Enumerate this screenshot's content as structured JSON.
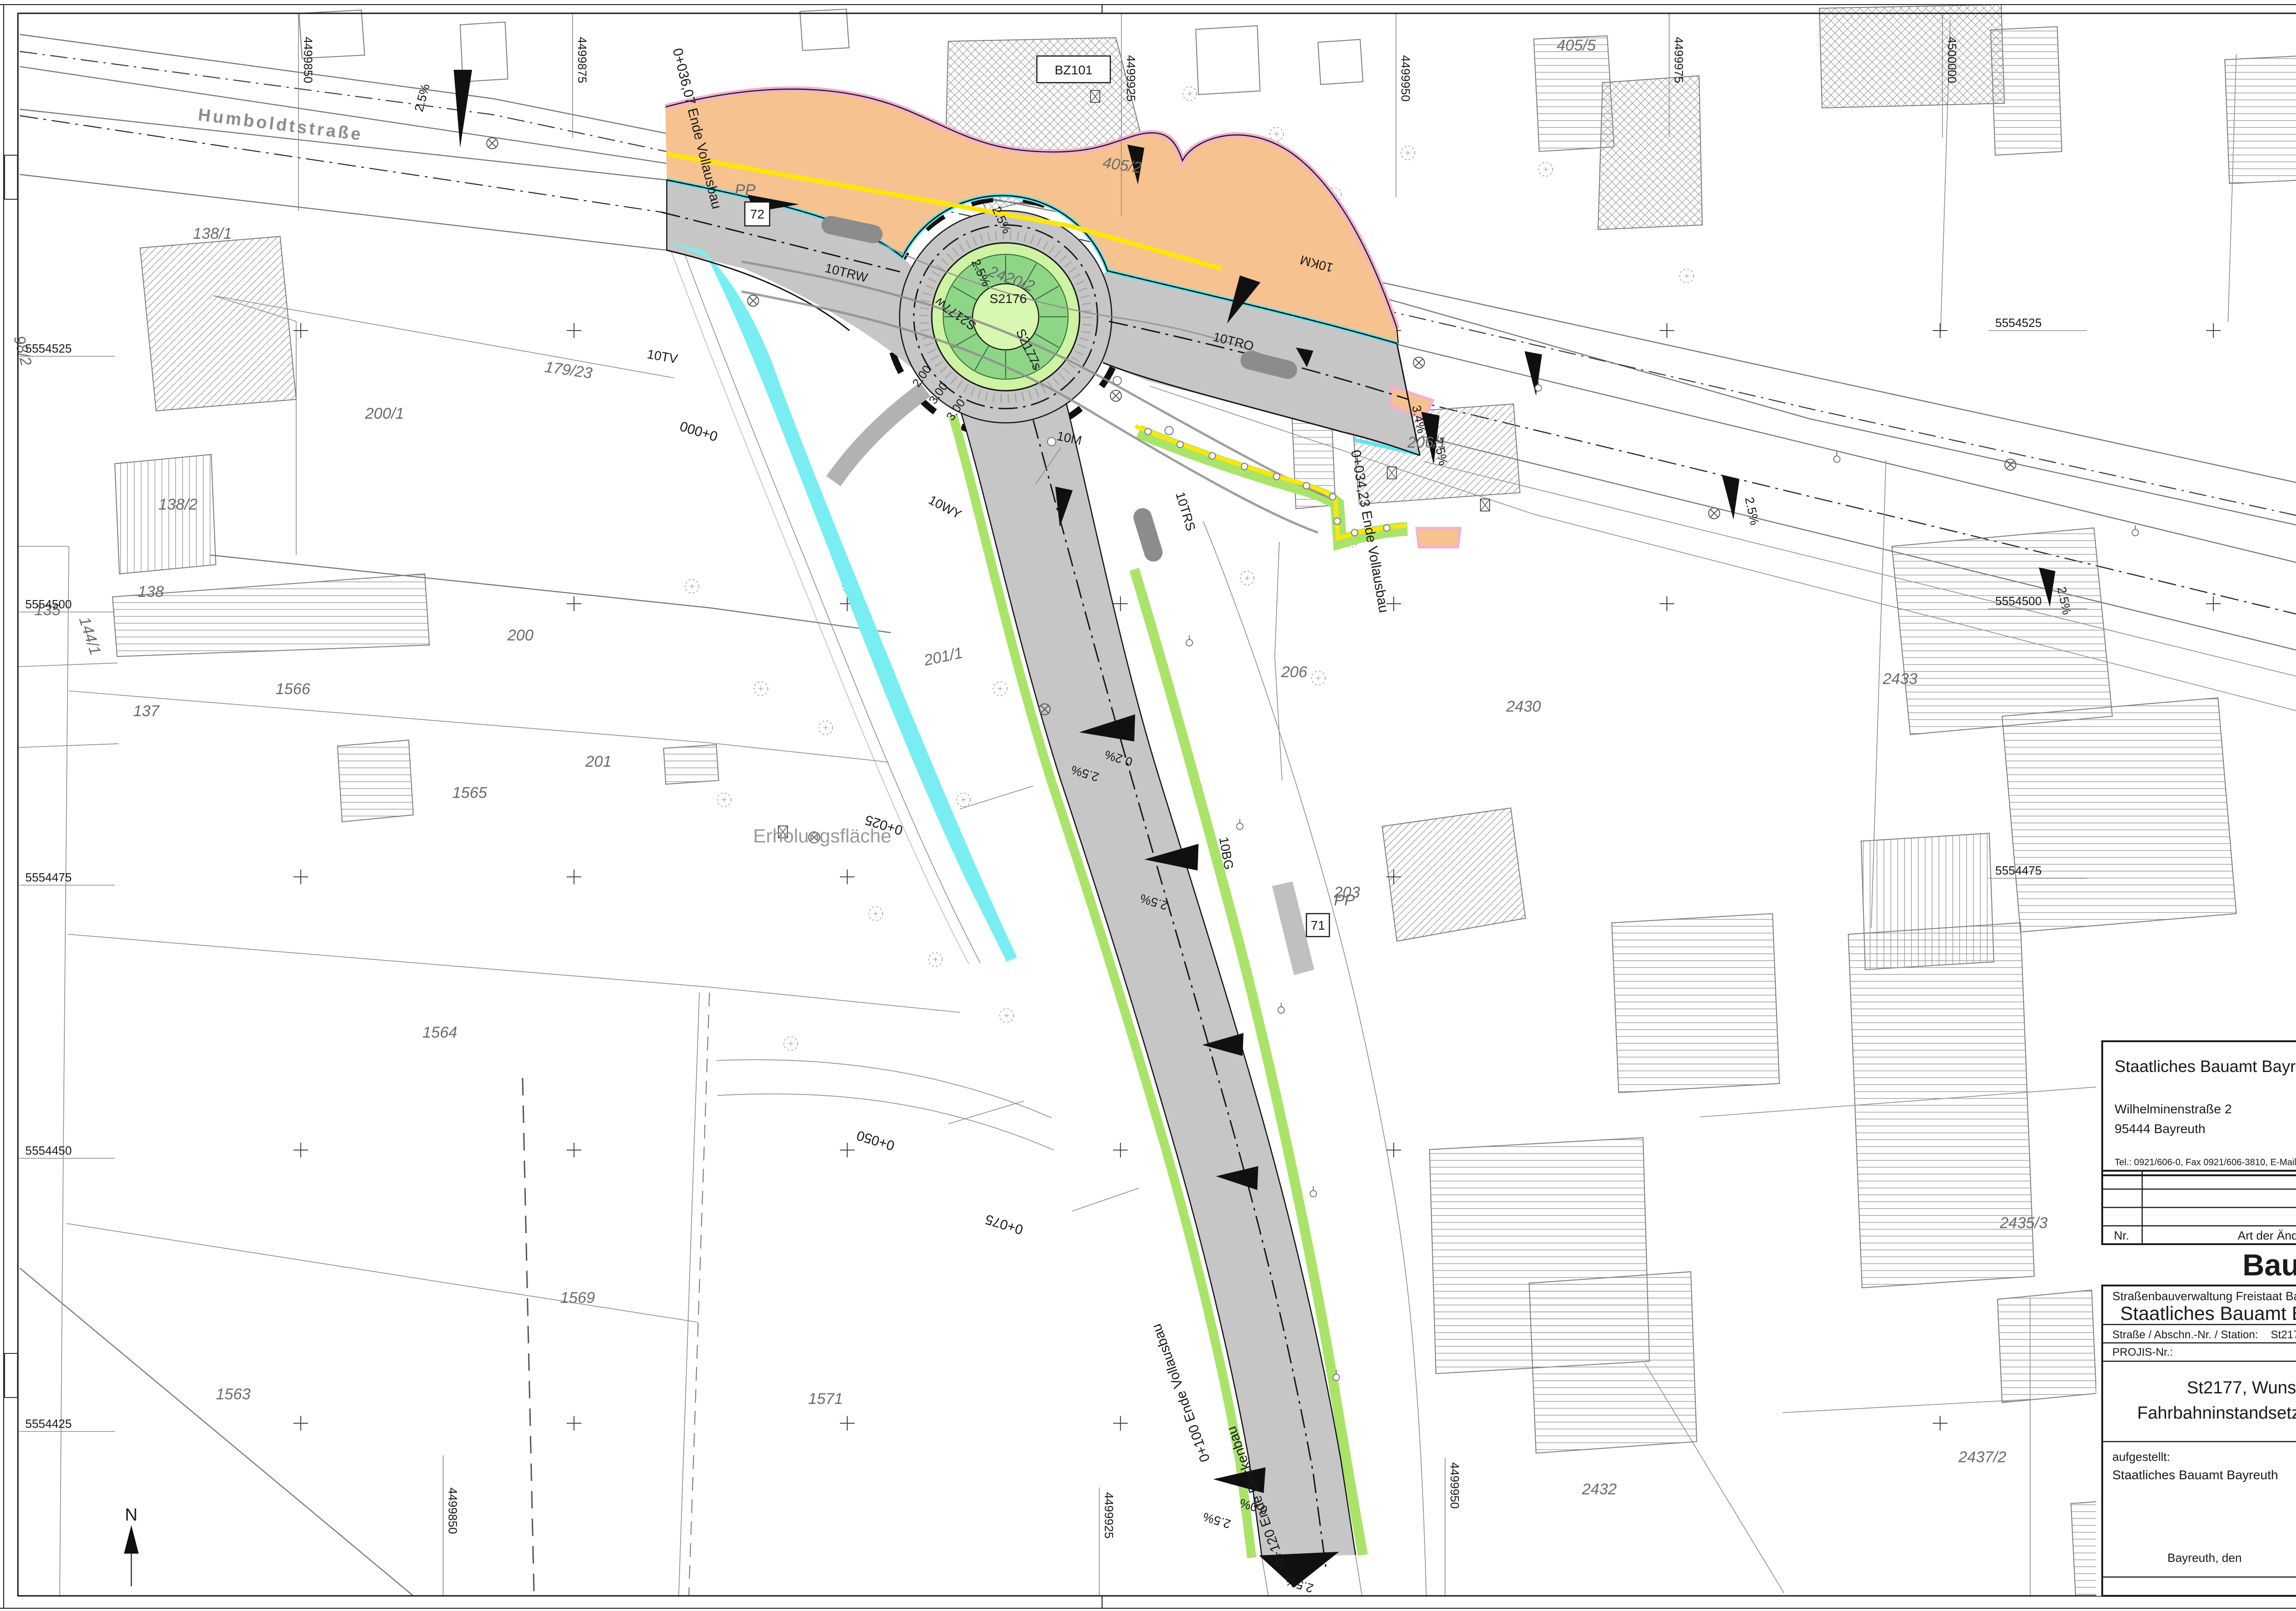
{
  "map": {
    "labels": {
      "street": "Humboldtstraße",
      "erholung": "Erholungsfläche",
      "north": "N",
      "bz101": "BZ101",
      "b72": "72",
      "b71": "71",
      "pp": "PP",
      "trw": "10TRW",
      "tro": "10TRO",
      "trs": "10TRS",
      "wy": "10WY",
      "bg": "10BG",
      "tv": "10TV",
      "km": "10KM",
      "m10": "10M",
      "s2176": "S2176",
      "s2177w": "S2177w",
      "s2177s": "S2177s",
      "p2420_2": "2420/2",
      "d200": "2.00",
      "d300": "3.00",
      "p138_1": "138/1",
      "p138_2": "138/2",
      "p138": "138",
      "p137": "137",
      "p135": "135",
      "p98_2": "98/2",
      "p144_1": "144/1",
      "p179_23": "179/23",
      "p200_1": "200/1",
      "p200": "200",
      "p201_1": "201/1",
      "p201": "201",
      "p203": "203",
      "p206": "206",
      "p206_1": "206/1",
      "p405_2": "405/2",
      "p405_5": "405/5",
      "p1566": "1566",
      "p1565": "1565",
      "p1564": "1564",
      "p1563": "1563",
      "p1569": "1569",
      "p1571": "1571",
      "p2430": "2430",
      "p2432": "2432",
      "p2433": "2433",
      "p2435_3": "2435/3",
      "p2437_2": "2437/2"
    },
    "stations": {
      "s000": "0+000",
      "s025": "0+025",
      "s050": "0+050",
      "s075": "0+075",
      "s100": "0+100 Ende Vollausbau",
      "s120": "0+120 Ende Deckenbau",
      "s034": "0+034,23 Ende Vollausbau",
      "s036": "0+036,07 Ende Vollausbau"
    },
    "slopes": {
      "p25": "2.5%",
      "p34": "3.4%",
      "p02": "0.2%",
      "p00": "0.0%"
    },
    "grid": {
      "gx850": "4499850",
      "gx875": "4499875",
      "gx925": "4499925",
      "gx950": "4499950",
      "gx975": "4499975",
      "gx000": "4500000",
      "gy525": "5554525",
      "gy500": "5554500",
      "gy475": "5554475",
      "gy450": "5554450",
      "gy425": "5554425"
    }
  },
  "titleblock": {
    "tb_top": {
      "agency": "Staatliches Bauamt Bayreuth",
      "address1": "Wilhelminenstraße 2",
      "address2": "95444 Bayreuth",
      "contact": "Tel.: 0921/606-0, Fax 0921/606-3810, E-Mail: poststelle@stbabt.bayern.de",
      "bearbeitet_label": "bearbeitet:",
      "bearbeitet_value": "01/2024",
      "bearbeitet_sign": "S21",
      "gezeichnet_label": "gezeichnet:",
      "geprueft_label": "geprüft:",
      "psp_label": "PSP Nr.:",
      "projekt_label": "Projekt:",
      "projekt_value": "S2177_S2176_Marktleuthen_KVP"
    },
    "revision": {
      "nr": "Nr.",
      "art": "Art der Änderung",
      "datum": "Datum",
      "zeichen": "Zeichen"
    },
    "stamp": "Bauentwurf",
    "tb_main": {
      "verwaltung": "Straßenbauverwaltung Freistaat Bayern",
      "amt": "Staatliches Bauamt Bayreuth",
      "strasse_label": "Straße / Abschn.-Nr. / Station:",
      "strasse_value": "St2177 / 560 / 5,760 - 580 / 0,040",
      "projis_label": "PROJIS-Nr.:",
      "unterlage_label": "Unterlage / Blatt-Nr.:",
      "unterlage_value": "Lageplan",
      "unterlage_sub": "KVP",
      "massstab_label": "Maßstab:",
      "massstab_value": "1 : 250",
      "title1": "St2177, Wunsiedel - (Kirchenlamitz)",
      "title2": "Fahrbahninstandsetzung in der OD Marktleuthen",
      "aufgestellt_label": "aufgestellt:",
      "aufgestellt_value": "Staatliches Bauamt Bayreuth",
      "ort_datum": "Bayreuth, den"
    }
  },
  "colors": {
    "asphalt_new": "#c6c6c6",
    "island_ring_light": "#cdf3a3",
    "island_ring_dark": "#8fd588",
    "island_center": "#d8f7b0",
    "verge_green": "#a9e469",
    "gutter_cyan": "#79eef2",
    "sidewalk_orange": "#f6c28f",
    "curb_pink": "#f2b0d0",
    "marking_yellow": "#ffe60a",
    "slope_arrow_black": "#101010"
  }
}
